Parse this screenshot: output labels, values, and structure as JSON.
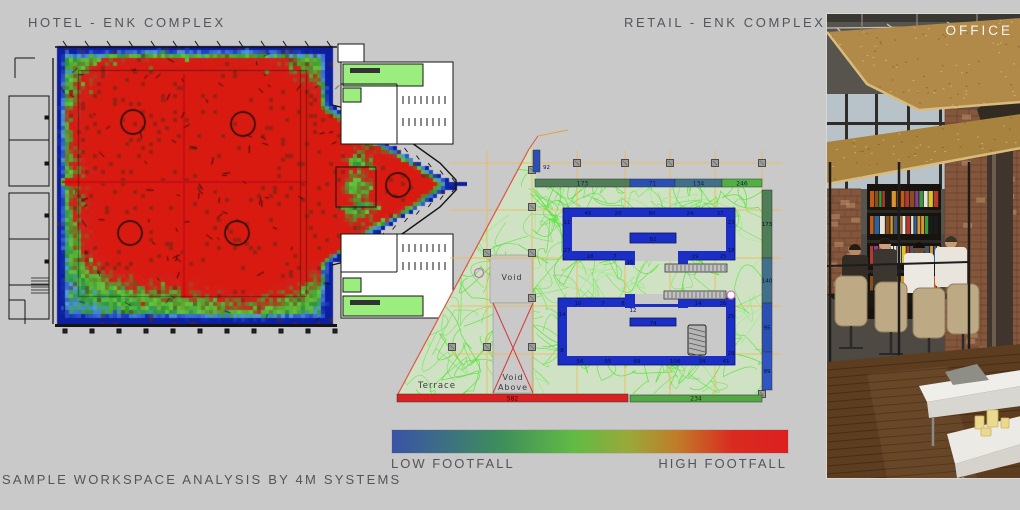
{
  "slide": {
    "background": "#c9c9c9",
    "footer_caption": "SAMPLE WORKSPACE ANALYSIS BY 4M SYSTEMS"
  },
  "panels": {
    "hotel": {
      "title": "HOTEL - ENK COMPLEX"
    },
    "retail": {
      "title": "RETAIL - ENK COMPLEX"
    },
    "office": {
      "title": "OFFICE"
    }
  },
  "legend": {
    "low_label": "LOW FOOTFALL",
    "high_label": "HIGH FOOTFALL",
    "gradient_stops": [
      {
        "color": "#3a53a7",
        "pos": 0
      },
      {
        "color": "#3f8f5a",
        "pos": 0.28
      },
      {
        "color": "#62bb45",
        "pos": 0.46
      },
      {
        "color": "#9aa83a",
        "pos": 0.6
      },
      {
        "color": "#c07c29",
        "pos": 0.72
      },
      {
        "color": "#d92b20",
        "pos": 0.86
      },
      {
        "color": "#dc2020",
        "pos": 1
      }
    ]
  },
  "chart_data": [
    {
      "type": "heatmap",
      "title": "HOTEL - ENK COMPLEX",
      "description": "Pedestrian footfall intensity simulated over the hotel ground-floor plan; blue = low, green = medium, red = high",
      "color_scale": {
        "low": "LOW FOOTFALL",
        "high": "HIGH FOOTFALL",
        "low_color": "#1c2fb0",
        "mid_color": "#4fae3d",
        "high_color": "#d81a10"
      },
      "hotspots": [
        {
          "x": 0.195,
          "y": 0.27,
          "intensity": 1.0,
          "radius": 0.125
        },
        {
          "x": 0.47,
          "y": 0.28,
          "intensity": 1.0,
          "radius": 0.135
        },
        {
          "x": 0.62,
          "y": 0.51,
          "intensity": 1.05,
          "radius": 0.13
        },
        {
          "x": 0.187,
          "y": 0.67,
          "intensity": 0.85,
          "radius": 0.1
        },
        {
          "x": 0.454,
          "y": 0.67,
          "intensity": 1.0,
          "radius": 0.125
        },
        {
          "x": 0.855,
          "y": 0.5,
          "intensity": 0.95,
          "radius": 0.09
        },
        {
          "x": 0.748,
          "y": 0.5,
          "intensity": -1.3,
          "radius": 0.06
        }
      ],
      "ridges": {
        "horizontal_y": 0.486,
        "vertical_x": 0.322
      }
    },
    {
      "type": "heatmap",
      "title": "RETAIL - ENK COMPLEX",
      "description": "Footfall trace simulation over retail floor plan with zone entry counts",
      "edge_counts": {
        "top": [
          173,
          71,
          134,
          246
        ],
        "left": [
          92
        ],
        "right": [
          173,
          140,
          95,
          99
        ],
        "bottom": [
          582,
          234
        ]
      },
      "edge_colors": {
        "top": [
          "#4f7d55",
          "#2b50b5",
          "#41708a",
          "#52b043"
        ],
        "left": [
          "#2b50b5"
        ],
        "right": [
          "#4f7d55",
          "#41708a",
          "#2b50b5",
          "#2e55c0"
        ],
        "bottom": [
          "#d92121",
          "#52a843"
        ]
      },
      "unit_counts": {
        "upper_top": [
          45,
          20,
          80,
          24,
          37
        ],
        "upper_bottom": [
          18,
          7,
          16,
          19,
          25
        ],
        "upper_left": [
          11,
          27
        ],
        "upper_right": [
          23,
          18
        ],
        "upper_mid": 82,
        "lower_top": [
          10,
          7,
          8,
          12,
          14,
          26
        ],
        "lower_bottom": [
          56,
          55,
          69,
          108,
          34,
          41
        ],
        "lower_left": [
          14,
          8
        ],
        "lower_right": [
          25,
          29
        ],
        "lower_mid": 74
      },
      "labels": {
        "terrace": "Terrace",
        "void": "Void",
        "void_above": [
          "Void",
          "Above"
        ]
      }
    }
  ]
}
